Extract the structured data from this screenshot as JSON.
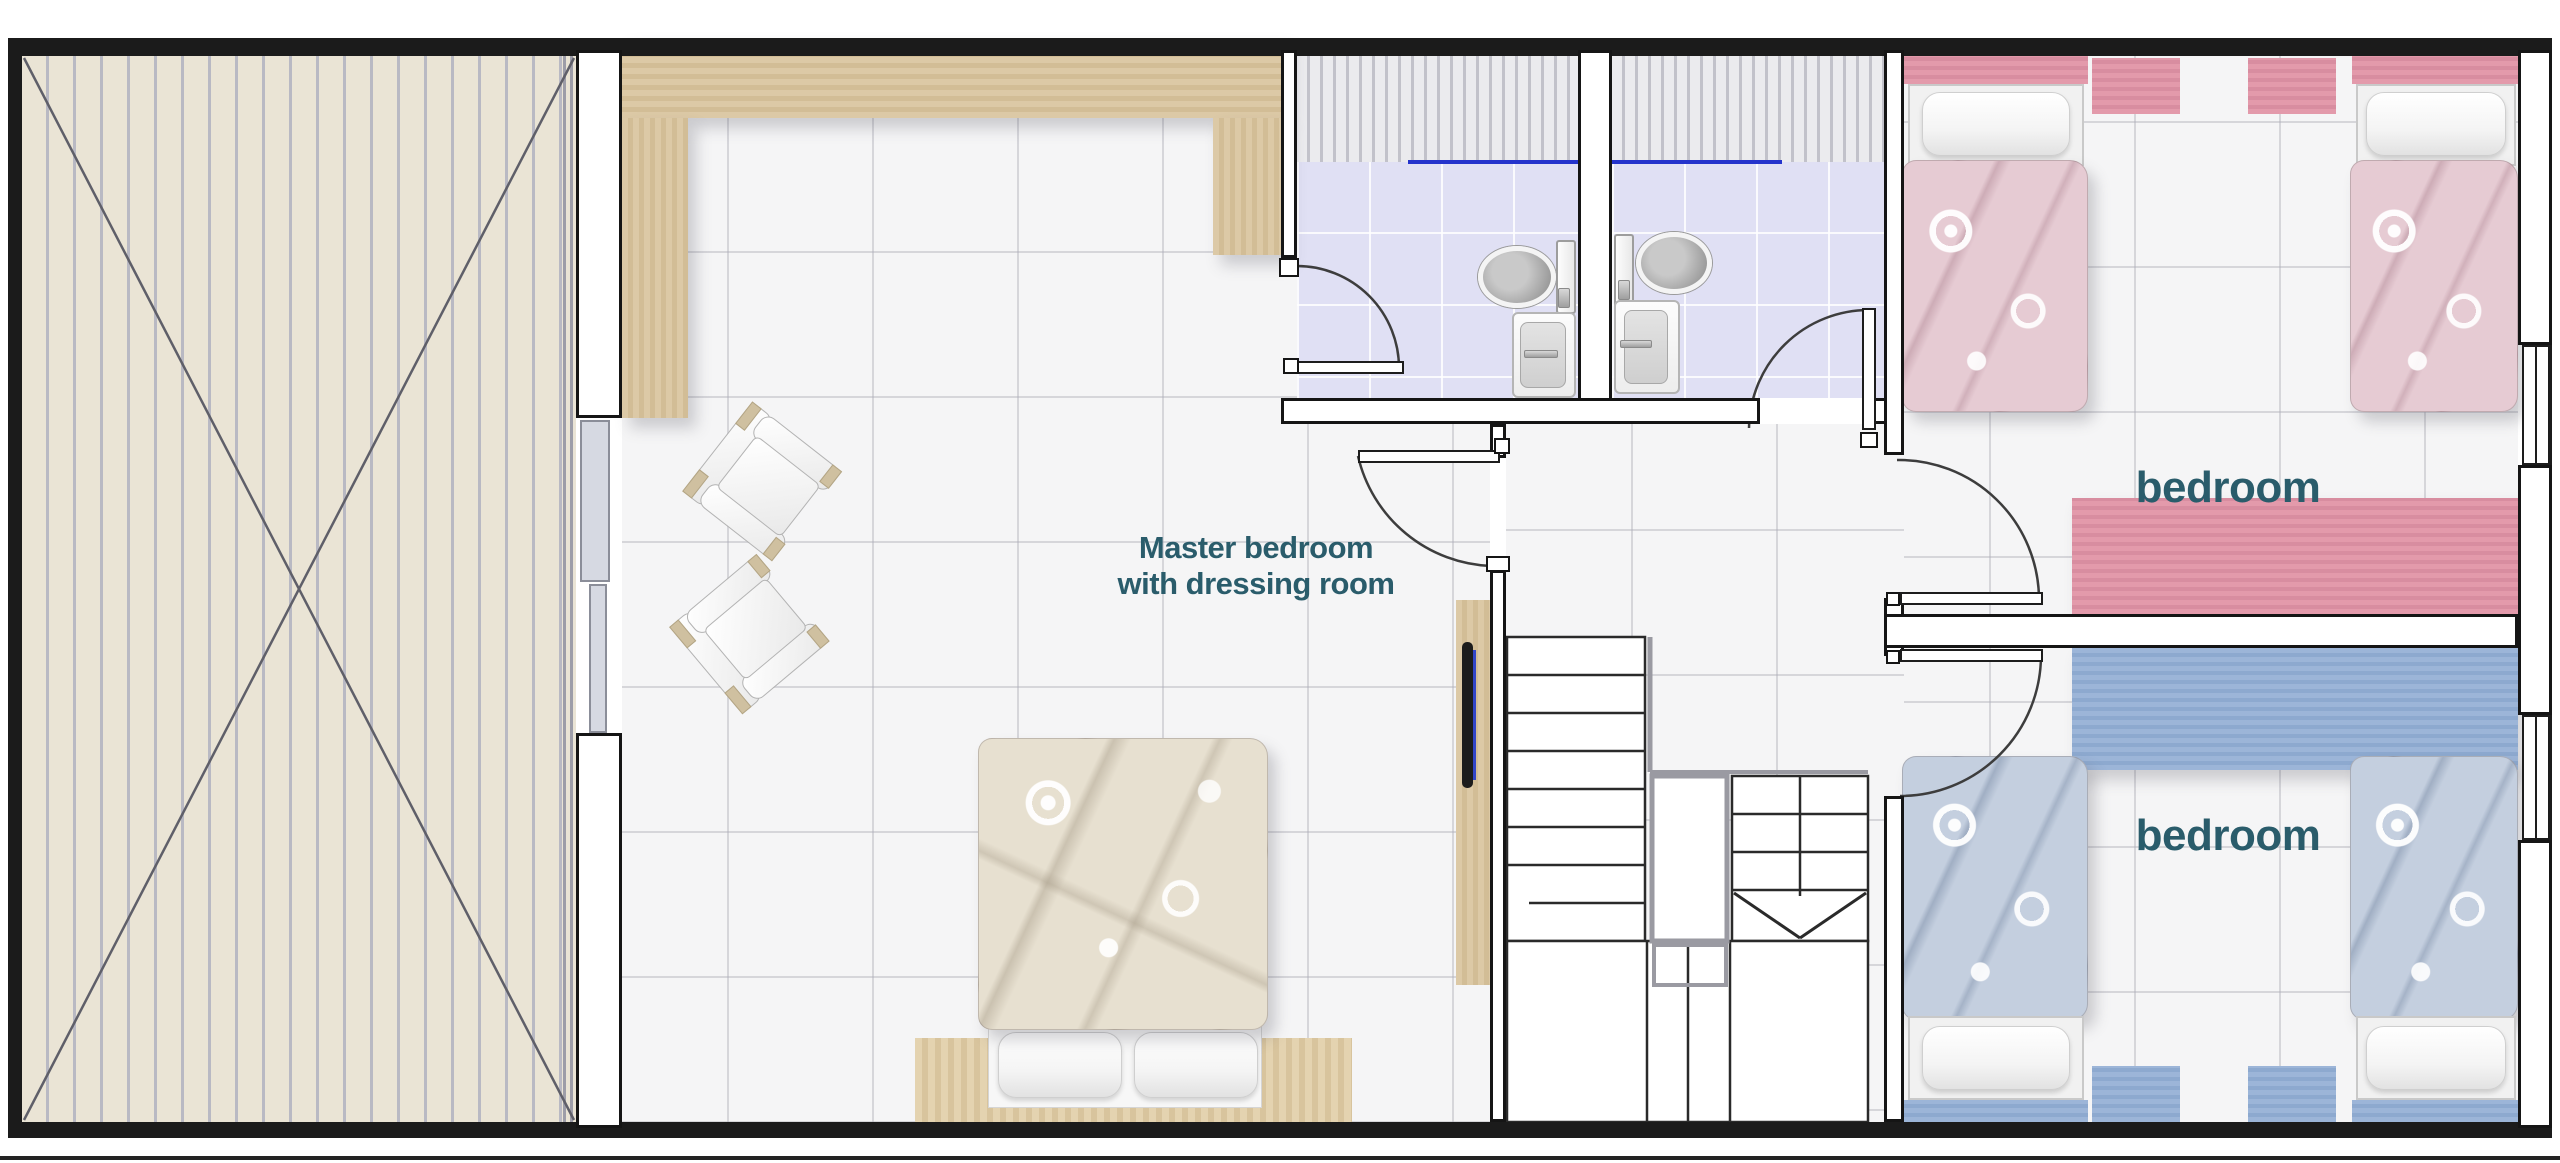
{
  "floorplan": {
    "rooms": {
      "master_bedroom": {
        "label_line1": "Master bedroom",
        "label_line2": "with dressing room"
      },
      "bedroom_top_right": {
        "label": "bedroom"
      },
      "bedroom_bottom_right": {
        "label": "bedroom"
      }
    },
    "colors": {
      "room_label": "#2a5c6b",
      "wood_light": "#d9c5a0",
      "terrace_deck": "#eae4d5",
      "pink_furniture": "#dd90a2",
      "pink_bedding": "#e6cbd3",
      "blue_furniture": "#92aed3",
      "blue_bedding": "#c4cfdf",
      "master_bedding": "#e7e0d0",
      "bathroom_floor": "#e0e0f4",
      "shower_screen_line": "#2433cc",
      "wall": "#1b1b1b"
    }
  }
}
